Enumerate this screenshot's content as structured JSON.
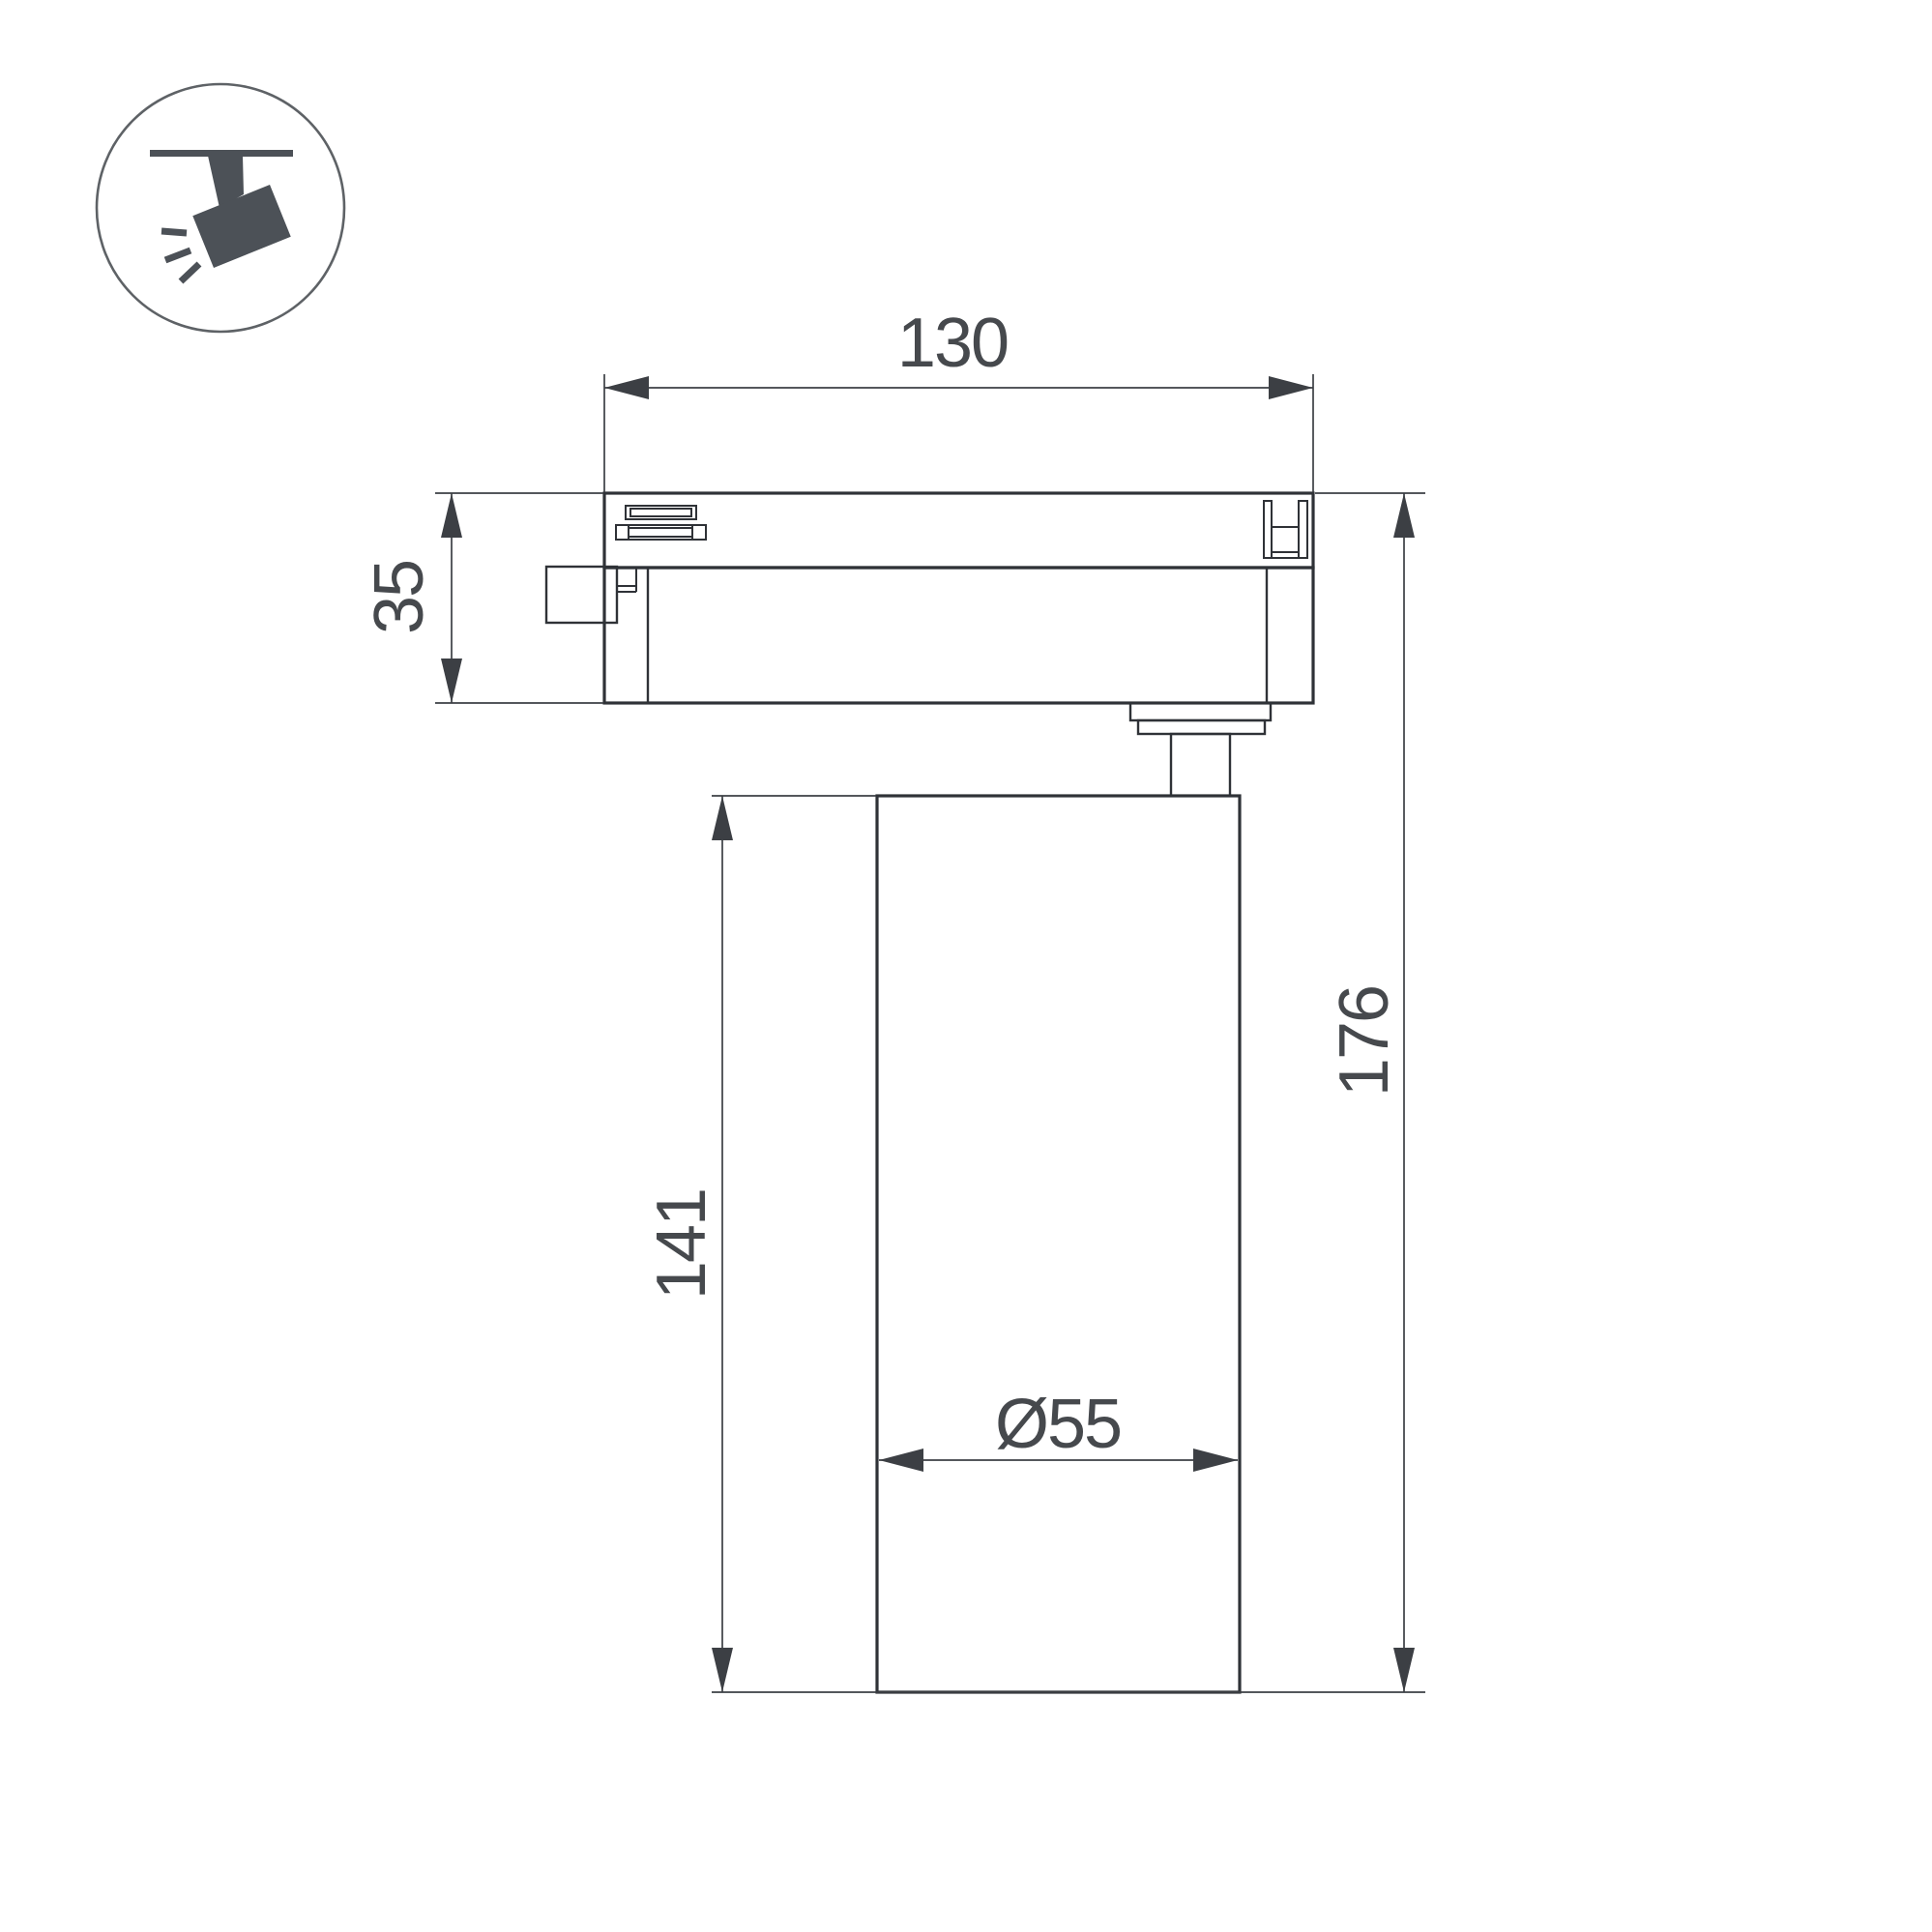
{
  "icon": {
    "name": "track-spotlight-icon",
    "description": "spotlight hanging from ceiling track, light rays shining down-left"
  },
  "drawing": {
    "kind": "technical dimension drawing, side view of LED track light",
    "labels": {
      "track_width": "130",
      "adapter_height": "35",
      "body_height": "141",
      "overall_height": "176",
      "body_diameter": "Ø55"
    }
  },
  "colors": {
    "object_line": "#2f3237",
    "dimension_line": "#3c3f44",
    "dimension_text": "#46494d",
    "icon_fill": "#4c5157",
    "icon_circle_stroke": "#5e6266",
    "background": "#ffffff"
  }
}
